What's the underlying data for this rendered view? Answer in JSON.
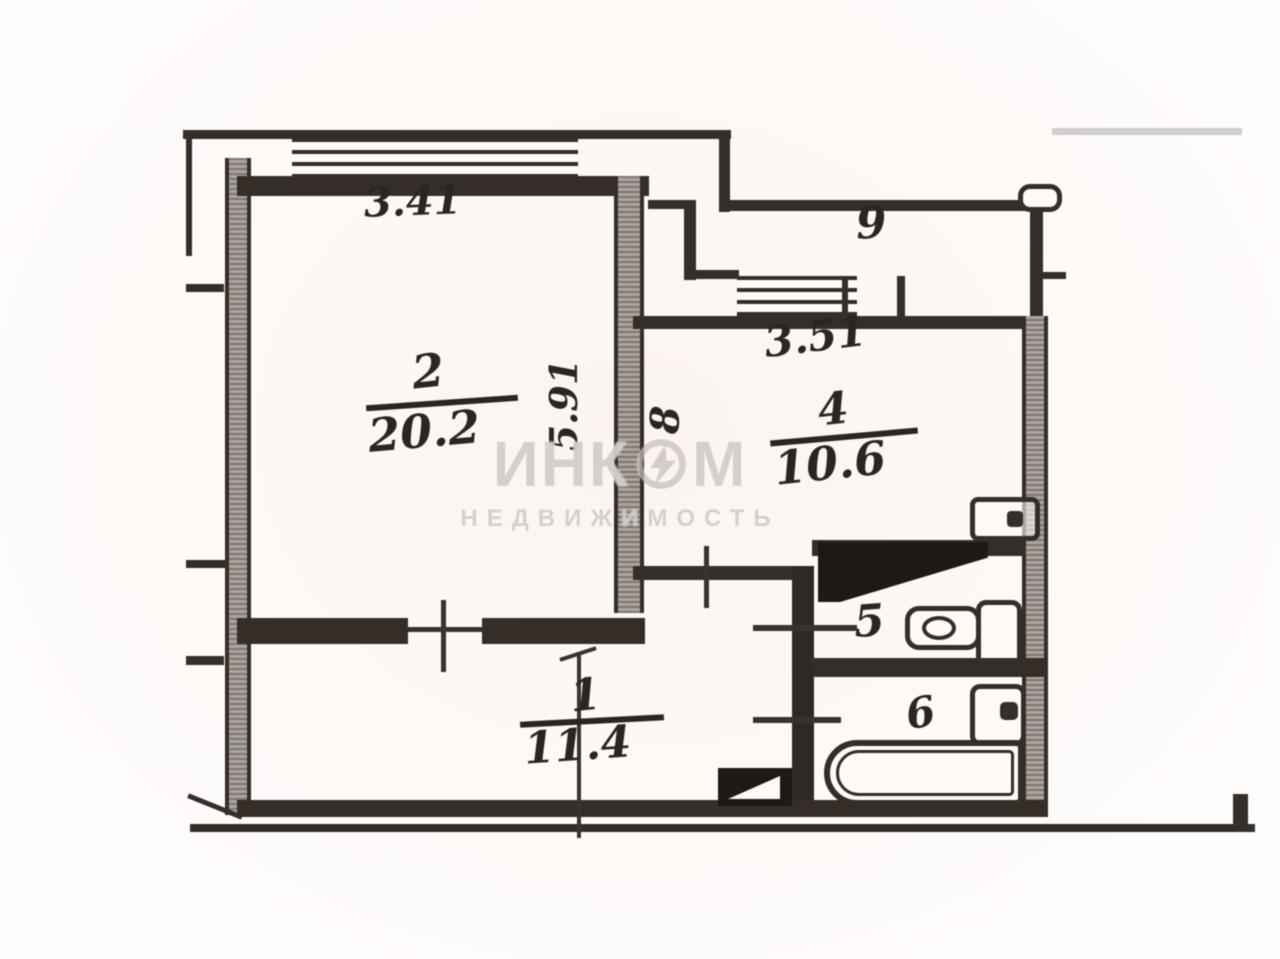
{
  "watermark": {
    "brand_left": "ИНК",
    "brand_right": "М",
    "subtitle": "НЕДВИЖИМОСТЬ"
  },
  "labels": {
    "room2": {
      "number": "2",
      "area": "20.2",
      "width": "3.41",
      "depth": "5.91"
    },
    "room9": {
      "number": "9",
      "width": "3.51"
    },
    "room4": {
      "number": "4",
      "area": "10.6",
      "niche": "8"
    },
    "room5": {
      "number": "5"
    },
    "room6": {
      "number": "6"
    },
    "room1": {
      "number": "1",
      "area": "11.4"
    }
  },
  "colors": {
    "ink": "#342d28",
    "paper": "#fdfaf8",
    "wall_fill": "#a39a93",
    "watermark": "#c6beb9"
  }
}
